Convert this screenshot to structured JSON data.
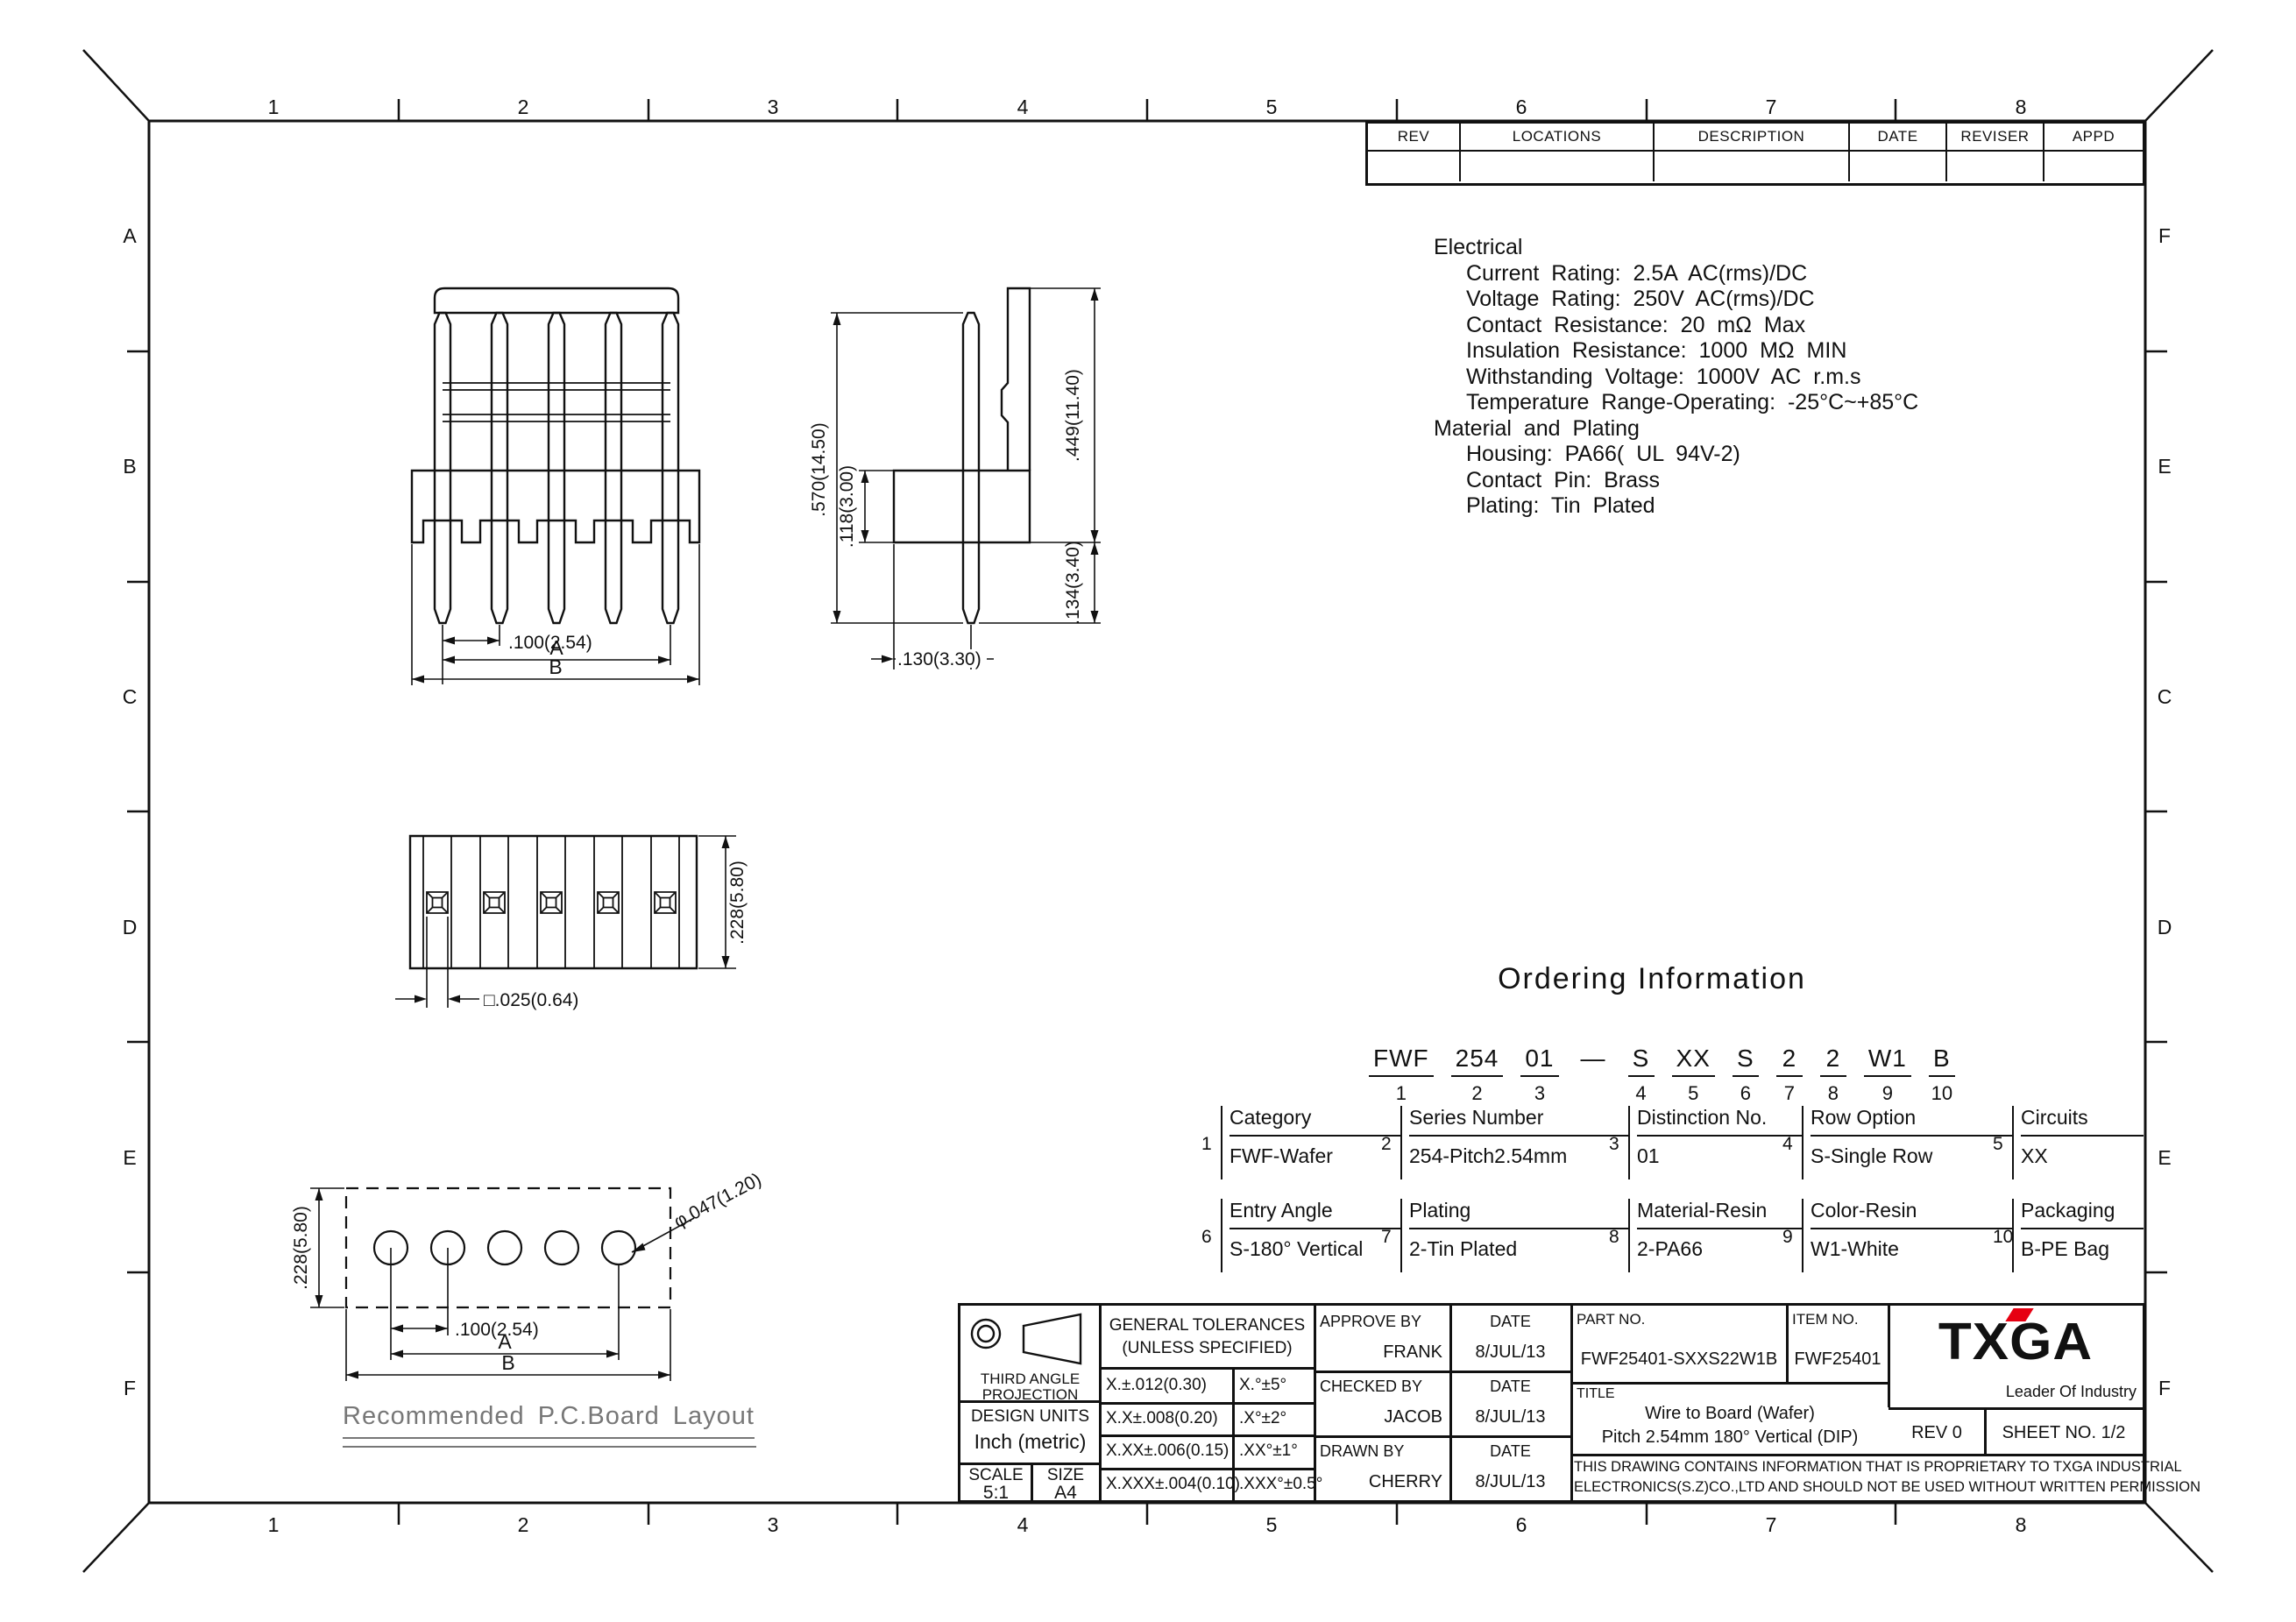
{
  "border": {
    "cols": [
      "1",
      "2",
      "3",
      "4",
      "5",
      "6",
      "7",
      "8"
    ],
    "rows_left": [
      "A",
      "B",
      "C",
      "D",
      "E",
      "F"
    ],
    "rows_right": [
      "F",
      "E",
      "C",
      "D",
      "E",
      "F"
    ]
  },
  "revision_table": {
    "headers": [
      "REV",
      "LOCATIONS",
      "DESCRIPTION",
      "DATE",
      "REVISER",
      "APPD"
    ]
  },
  "specs": {
    "lines": [
      "Electrical",
      "Current Rating: 2.5A AC(rms)/DC",
      "Voltage Rating: 250V AC(rms)/DC",
      "Contact Resistance: 20 mΩ Max",
      "Insulation Resistance: 1000 MΩ MIN",
      "Withstanding Voltage: 1000V AC r.m.s",
      "Temperature Range-Operating: -25°C~+85°C",
      "Material and Plating",
      "Housing: PA66( UL 94V-2)",
      "Contact Pin: Brass",
      "Plating: Tin Plated"
    ]
  },
  "ordering": {
    "title": "Ordering Information",
    "segments": [
      {
        "code": "FWF",
        "num": "1"
      },
      {
        "code": "254",
        "num": "2"
      },
      {
        "code": "01",
        "num": "3"
      },
      {
        "code": "—",
        "num": ""
      },
      {
        "code": "S",
        "num": "4"
      },
      {
        "code": "XX",
        "num": "5"
      },
      {
        "code": "S",
        "num": "6"
      },
      {
        "code": "2",
        "num": "7"
      },
      {
        "code": "2",
        "num": "8"
      },
      {
        "code": "W1",
        "num": "9"
      },
      {
        "code": "B",
        "num": "10"
      }
    ],
    "fields": [
      {
        "num": "1",
        "label": "Category",
        "value": "FWF-Wafer"
      },
      {
        "num": "2",
        "label": "Series Number",
        "value": "254-Pitch2.54mm"
      },
      {
        "num": "3",
        "label": "Distinction No.",
        "value": "01"
      },
      {
        "num": "4",
        "label": "Row Option",
        "value": "S-Single Row"
      },
      {
        "num": "5",
        "label": "Circuits",
        "value": "XX"
      },
      {
        "num": "6",
        "label": "Entry Angle",
        "value": "S-180° Vertical"
      },
      {
        "num": "7",
        "label": "Plating",
        "value": "2-Tin Plated"
      },
      {
        "num": "8",
        "label": "Material-Resin",
        "value": "2-PA66"
      },
      {
        "num": "9",
        "label": "Color-Resin",
        "value": "W1-White"
      },
      {
        "num": "10",
        "label": "Packaging",
        "value": "B-PE Bag"
      }
    ]
  },
  "views": {
    "front": {
      "dim_pitch": ".100(2.54)",
      "dim_a": "A",
      "dim_b": "B"
    },
    "side": {
      "dim_height": ".570(14.50)",
      "dim_body": ".118(3.00)",
      "dim_upper": ".449(11.40)",
      "dim_lower": ".134(3.40)",
      "dim_offset": ".130(3.30)"
    },
    "bottom": {
      "dim_width": ".228(5.80)",
      "dim_pin": "□.025(0.64)"
    },
    "pcb": {
      "dim_width": ".228(5.80)",
      "dim_hole": "φ.047(1.20)",
      "dim_pitch": ".100(2.54)",
      "dim_a": "A",
      "dim_b": "B",
      "caption": "Recommended P.C.Board Layout"
    }
  },
  "title_block": {
    "projection": {
      "line1": "THIRD ANGLE",
      "line2": "PROJECTION"
    },
    "tolerances": {
      "title1": "GENERAL TOLERANCES",
      "title2": "(UNLESS SPECIFIED)",
      "rows": [
        {
          "lin": "X.±.012(0.30)",
          "ang": "X.°±5°"
        },
        {
          "lin": "X.X±.008(0.20)",
          "ang": ".X°±2°"
        },
        {
          "lin": "X.XX±.006(0.15)",
          "ang": ".XX°±1°"
        },
        {
          "lin": "X.XXX±.004(0.10)",
          "ang": ".XXX°±0.5°"
        }
      ]
    },
    "design_units": {
      "label": "DESIGN UNITS",
      "value": "Inch (metric)"
    },
    "scale": {
      "label": "SCALE",
      "value": "5:1"
    },
    "size": {
      "label": "SIZE",
      "value": "A4"
    },
    "approvals": [
      {
        "role": "APPROVE BY",
        "name": "FRANK",
        "date_label": "DATE",
        "date": "8/JUL/13"
      },
      {
        "role": "CHECKED BY",
        "name": "JACOB",
        "date_label": "DATE",
        "date": "8/JUL/13"
      },
      {
        "role": "DRAWN BY",
        "name": "CHERRY",
        "date_label": "DATE",
        "date": "8/JUL/13"
      }
    ],
    "part_no": {
      "label": "PART NO.",
      "value": "FWF25401-SXXS22W1B"
    },
    "item_no": {
      "label": "ITEM NO.",
      "value": "FWF25401"
    },
    "title": {
      "label": "TITLE",
      "line1": "Wire to Board (Wafer)",
      "line2": "Pitch 2.54mm 180° Vertical (DIP)"
    },
    "logo": {
      "text": "TXGA",
      "tagline": "Leader Of Industry",
      "accent_color": "#e60012"
    },
    "rev": "REV 0",
    "sheet": "SHEET NO. 1/2",
    "proprietary": {
      "line1": "THIS DRAWING CONTAINS INFORMATION THAT IS PROPRIETARY TO TXGA INDUSTRIAL",
      "line2": "ELECTRONICS(S.Z)CO.,LTD AND SHOULD NOT BE USED WITHOUT WRITTEN PERMISSION"
    }
  }
}
